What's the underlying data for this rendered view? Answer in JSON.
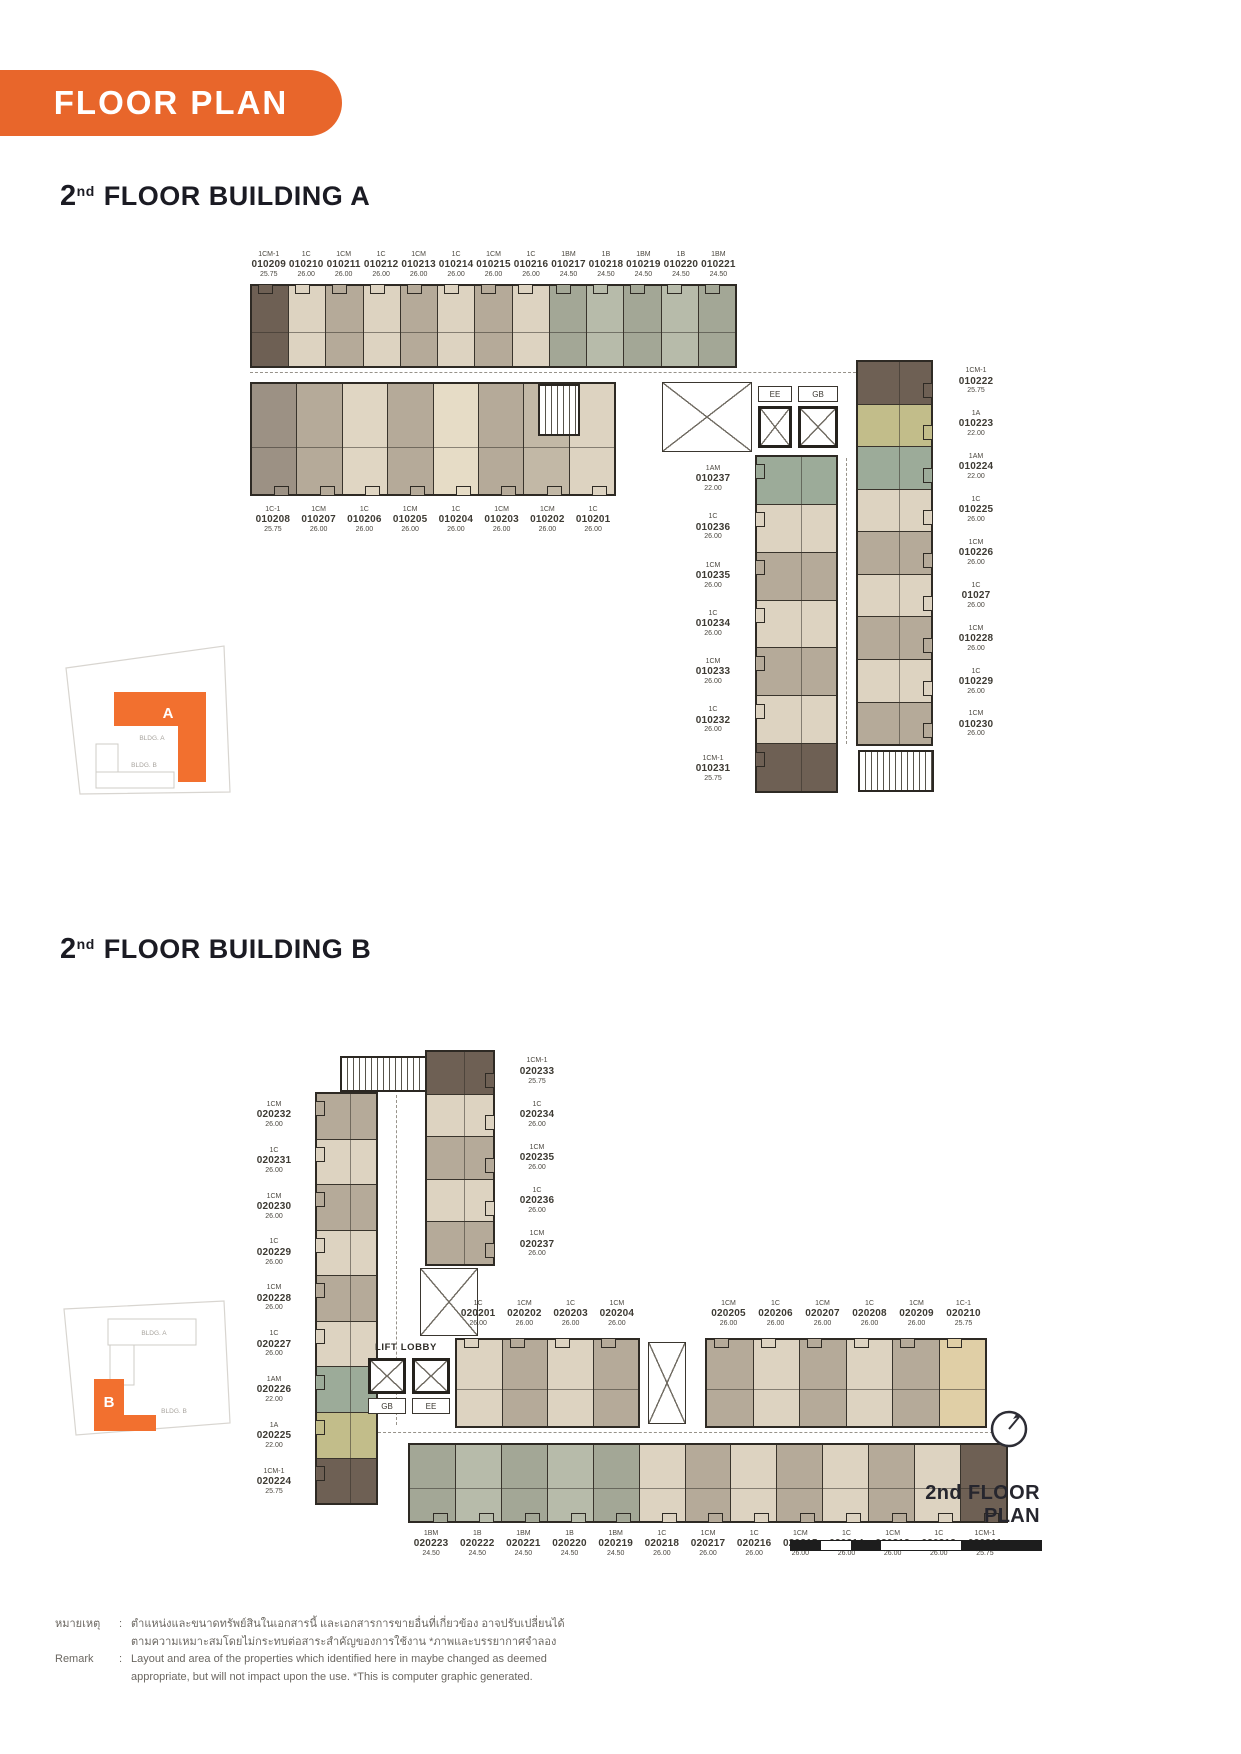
{
  "page": {
    "badge": "FLOOR PLAN"
  },
  "buildingA": {
    "title_num": "2",
    "title_sup": "nd",
    "title_rest": "FLOOR BUILDING A",
    "top_units": [
      {
        "type": "1CM-1",
        "no": "010209",
        "area": "25.75",
        "color": "#6e6054"
      },
      {
        "type": "1C",
        "no": "010210",
        "area": "26.00",
        "color": "#ddd3c1"
      },
      {
        "type": "1CM",
        "no": "010211",
        "area": "26.00",
        "color": "#b5aa99"
      },
      {
        "type": "1C",
        "no": "010212",
        "area": "26.00",
        "color": "#ddd3c1"
      },
      {
        "type": "1CM",
        "no": "010213",
        "area": "26.00",
        "color": "#b5aa99"
      },
      {
        "type": "1C",
        "no": "010214",
        "area": "26.00",
        "color": "#ddd3c1"
      },
      {
        "type": "1CM",
        "no": "010215",
        "area": "26.00",
        "color": "#b5aa99"
      },
      {
        "type": "1C",
        "no": "010216",
        "area": "26.00",
        "color": "#ddd3c1"
      },
      {
        "type": "1BM",
        "no": "010217",
        "area": "24.50",
        "color": "#a3a796"
      },
      {
        "type": "1B",
        "no": "010218",
        "area": "24.50",
        "color": "#b7bbaa"
      },
      {
        "type": "1BM",
        "no": "010219",
        "area": "24.50",
        "color": "#a3a796"
      },
      {
        "type": "1B",
        "no": "010220",
        "area": "24.50",
        "color": "#b7bbaa"
      },
      {
        "type": "1BM",
        "no": "010221",
        "area": "24.50",
        "color": "#a3a796"
      }
    ],
    "bottom_units": [
      {
        "type": "1C-1",
        "no": "010208",
        "area": "25.75",
        "color": "#9c9184"
      },
      {
        "type": "1CM",
        "no": "010207",
        "area": "26.00",
        "color": "#b5aa99"
      },
      {
        "type": "1C",
        "no": "010206",
        "area": "26.00",
        "color": "#e0d6c3"
      },
      {
        "type": "1CM",
        "no": "010205",
        "area": "26.00",
        "color": "#b5aa99"
      },
      {
        "type": "1C",
        "no": "010204",
        "area": "26.00",
        "color": "#e6dcc6"
      },
      {
        "type": "1CM",
        "no": "010203",
        "area": "26.00",
        "color": "#b5aa99"
      },
      {
        "type": "1CM",
        "no": "010202",
        "area": "26.00",
        "color": "#c2b8a6"
      },
      {
        "type": "1C",
        "no": "010201",
        "area": "26.00",
        "color": "#ddd3c1"
      }
    ],
    "right_units": [
      {
        "type": "1CM-1",
        "no": "010222",
        "area": "25.75",
        "color": "#6e6054"
      },
      {
        "type": "1A",
        "no": "010223",
        "area": "22.00",
        "color": "#c2bd8a"
      },
      {
        "type": "1AM",
        "no": "010224",
        "area": "22.00",
        "color": "#9cab99"
      },
      {
        "type": "1C",
        "no": "010225",
        "area": "26.00",
        "color": "#ddd3c1"
      },
      {
        "type": "1CM",
        "no": "010226",
        "area": "26.00",
        "color": "#b5aa99"
      },
      {
        "type": "1C",
        "no": "01027",
        "area": "26.00",
        "color": "#ddd3c1"
      },
      {
        "type": "1CM",
        "no": "010228",
        "area": "26.00",
        "color": "#b5aa99"
      },
      {
        "type": "1C",
        "no": "010229",
        "area": "26.00",
        "color": "#ddd3c1"
      },
      {
        "type": "1CM",
        "no": "010230",
        "area": "26.00",
        "color": "#b5aa99"
      }
    ],
    "inner_units": [
      {
        "type": "1AM",
        "no": "010237",
        "area": "22.00",
        "color": "#9cab99"
      },
      {
        "type": "1C",
        "no": "010236",
        "area": "26.00",
        "color": "#ddd3c1"
      },
      {
        "type": "1CM",
        "no": "010235",
        "area": "26.00",
        "color": "#b5aa99"
      },
      {
        "type": "1C",
        "no": "010234",
        "area": "26.00",
        "color": "#ddd3c1"
      },
      {
        "type": "1CM",
        "no": "010233",
        "area": "26.00",
        "color": "#b5aa99"
      },
      {
        "type": "1C",
        "no": "010232",
        "area": "26.00",
        "color": "#ddd3c1"
      },
      {
        "type": "1CM-1",
        "no": "010231",
        "area": "25.75",
        "color": "#6e6054"
      }
    ],
    "core": {
      "ee": "EE",
      "gb": "GB",
      "lobby": "LIFT LOBBY"
    }
  },
  "buildingB": {
    "title_num": "2",
    "title_sup": "nd",
    "title_rest": "FLOOR BUILDING B",
    "left_units": [
      {
        "type": "1CM",
        "no": "020232",
        "area": "26.00",
        "color": "#b5aa99"
      },
      {
        "type": "1C",
        "no": "020231",
        "area": "26.00",
        "color": "#ddd3c1"
      },
      {
        "type": "1CM",
        "no": "020230",
        "area": "26.00",
        "color": "#b5aa99"
      },
      {
        "type": "1C",
        "no": "020229",
        "area": "26.00",
        "color": "#ddd3c1"
      },
      {
        "type": "1CM",
        "no": "020228",
        "area": "26.00",
        "color": "#b5aa99"
      },
      {
        "type": "1C",
        "no": "020227",
        "area": "26.00",
        "color": "#ddd3c1"
      },
      {
        "type": "1AM",
        "no": "020226",
        "area": "22.00",
        "color": "#9cab99"
      },
      {
        "type": "1A",
        "no": "020225",
        "area": "22.00",
        "color": "#c2bd8a"
      },
      {
        "type": "1CM-1",
        "no": "020224",
        "area": "25.75",
        "color": "#6e6054"
      }
    ],
    "inner_units": [
      {
        "type": "1CM-1",
        "no": "020233",
        "area": "25.75",
        "color": "#6e6054"
      },
      {
        "type": "1C",
        "no": "020234",
        "area": "26.00",
        "color": "#ddd3c1"
      },
      {
        "type": "1CM",
        "no": "020235",
        "area": "26.00",
        "color": "#b5aa99"
      },
      {
        "type": "1C",
        "no": "020236",
        "area": "26.00",
        "color": "#ddd3c1"
      },
      {
        "type": "1CM",
        "no": "020237",
        "area": "26.00",
        "color": "#b5aa99"
      }
    ],
    "top_left_units": [
      {
        "type": "1C",
        "no": "020201",
        "area": "26.00",
        "color": "#ddd3c1"
      },
      {
        "type": "1CM",
        "no": "020202",
        "area": "26.00",
        "color": "#b5aa99"
      },
      {
        "type": "1C",
        "no": "020203",
        "area": "26.00",
        "color": "#ddd3c1"
      },
      {
        "type": "1CM",
        "no": "020204",
        "area": "26.00",
        "color": "#b5aa99"
      }
    ],
    "top_right_units": [
      {
        "type": "1CM",
        "no": "020205",
        "area": "26.00",
        "color": "#b5aa99"
      },
      {
        "type": "1C",
        "no": "020206",
        "area": "26.00",
        "color": "#ddd3c1"
      },
      {
        "type": "1CM",
        "no": "020207",
        "area": "26.00",
        "color": "#b5aa99"
      },
      {
        "type": "1C",
        "no": "020208",
        "area": "26.00",
        "color": "#ddd3c1"
      },
      {
        "type": "1CM",
        "no": "020209",
        "area": "26.00",
        "color": "#b5aa99"
      },
      {
        "type": "1C-1",
        "no": "020210",
        "area": "25.75",
        "color": "#e0cfa6"
      }
    ],
    "bottom_units": [
      {
        "type": "1BM",
        "no": "020223",
        "area": "24.50",
        "color": "#a3a796"
      },
      {
        "type": "1B",
        "no": "020222",
        "area": "24.50",
        "color": "#b7bbaa"
      },
      {
        "type": "1BM",
        "no": "020221",
        "area": "24.50",
        "color": "#a3a796"
      },
      {
        "type": "1B",
        "no": "020220",
        "area": "24.50",
        "color": "#b7bbaa"
      },
      {
        "type": "1BM",
        "no": "020219",
        "area": "24.50",
        "color": "#a3a796"
      },
      {
        "type": "1C",
        "no": "020218",
        "area": "26.00",
        "color": "#ddd3c1"
      },
      {
        "type": "1CM",
        "no": "020217",
        "area": "26.00",
        "color": "#b5aa99"
      },
      {
        "type": "1C",
        "no": "020216",
        "area": "26.00",
        "color": "#ddd3c1"
      },
      {
        "type": "1CM",
        "no": "020215",
        "area": "26.00",
        "color": "#b5aa99"
      },
      {
        "type": "1C",
        "no": "020214",
        "area": "26.00",
        "color": "#ddd3c1"
      },
      {
        "type": "1CM",
        "no": "020213",
        "area": "26.00",
        "color": "#b5aa99"
      },
      {
        "type": "1C",
        "no": "020212",
        "area": "26.00",
        "color": "#ddd3c1"
      },
      {
        "type": "1CM-1",
        "no": "020211",
        "area": "25.75",
        "color": "#6e6054"
      }
    ],
    "core": {
      "gb": "GB",
      "ee": "EE",
      "lobby": "LIFT LOBBY"
    }
  },
  "site_a": {
    "marker": "A",
    "bldg_a_label": "BLDG. A",
    "bldg_b_label": "BLDG. B"
  },
  "site_b": {
    "marker": "B",
    "bldg_a_label": "BLDG. A",
    "bldg_b_label": "BLDG. B"
  },
  "footer": {
    "plan_title": "2nd FLOOR PLAN"
  },
  "remark": {
    "thai_label": "หมายเหตุ",
    "colon": ":",
    "thai_line1": "ตำแหน่งและขนาดทรัพย์สินในเอกสารนี้ และเอกสารการขายอื่นที่เกี่ยวข้อง อาจปรับเปลี่ยนได้",
    "thai_line2": "ตามความเหมาะสมโดยไม่กระทบต่อสาระสำคัญของการใช้งาน *ภาพและบรรยากาศจำลอง",
    "en_label": "Remark",
    "en_line1": "Layout and area of the properties which identified here in maybe changed as deemed",
    "en_line2": "appropriate, but will not impact upon the use. *This is computer graphic generated."
  },
  "colors": {
    "accent_orange": "#E8662B",
    "site_orange": "#F2702F",
    "wall": "#2e2a24"
  }
}
